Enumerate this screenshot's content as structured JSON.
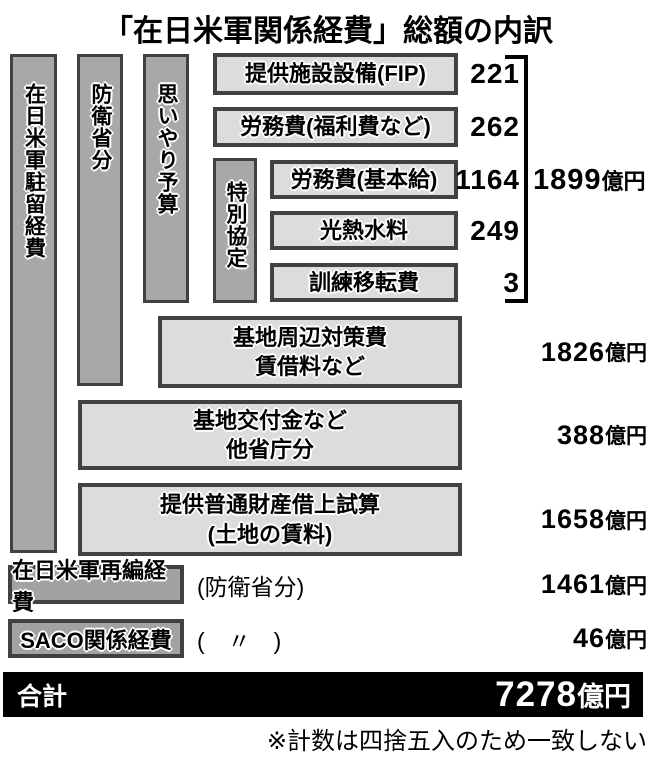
{
  "title": "「在日米軍関係経費」総額の内訳",
  "colors": {
    "bar_fill": "#a8a8a8",
    "box_fill": "#dcdcdc",
    "border": "#414141",
    "total_bg": "#000000",
    "total_text": "#ffffff"
  },
  "bars": [
    {
      "label": "在日米軍駐留経費"
    },
    {
      "label": "防衛省分"
    },
    {
      "label": "思いやり予算"
    },
    {
      "label": "特別協定"
    }
  ],
  "items": [
    {
      "label": "提供施設設備(FIP)",
      "value": "221"
    },
    {
      "label": "労務費(福利費など)",
      "value": "262"
    },
    {
      "label": "労務費(基本給)",
      "value": "1164"
    },
    {
      "label": "光熱水料",
      "value": "249"
    },
    {
      "label": "訓練移転費",
      "value": "3"
    }
  ],
  "subtotal": {
    "value": "1899",
    "unit": "億円"
  },
  "rows": [
    {
      "line1": "基地周辺対策費",
      "line2": "賃借料など",
      "value": "1826",
      "unit": "億円"
    },
    {
      "line1": "基地交付金など",
      "line2": "他省庁分",
      "value": "388",
      "unit": "億円"
    },
    {
      "line1": "提供普通財産借上試算",
      "line2": "(土地の賃料)",
      "value": "1658",
      "unit": "億円"
    }
  ],
  "extras": [
    {
      "label": "在日米軍再編経費",
      "note": "(防衛省分)",
      "value": "1461",
      "unit": "億円"
    },
    {
      "label": "SACO関係経費",
      "note": "(　〃　)",
      "value": "46",
      "unit": "億円"
    }
  ],
  "total": {
    "label": "合計",
    "value": "7278",
    "unit": "億円"
  },
  "footnote": "※計数は四捨五入のため一致しない"
}
